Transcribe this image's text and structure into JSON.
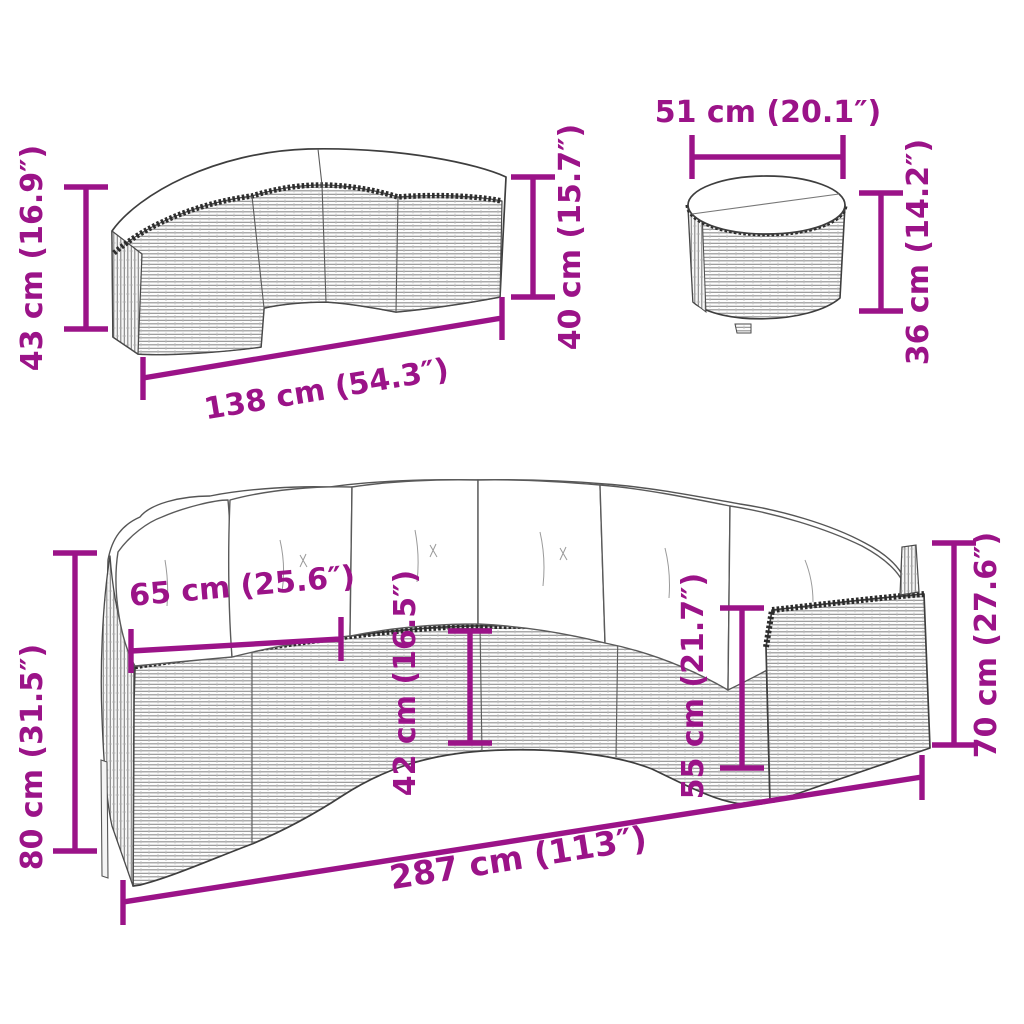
{
  "style": {
    "dimension_color": "#9B1388",
    "outline_color": "#3e3e3e",
    "weave_line_color": "#8f8f8f",
    "cushion_color": "#ffffff",
    "background": "#ffffff"
  },
  "figures": {
    "bench": {
      "dimensions": {
        "height_left": "43 cm (16.9″)",
        "width": "138 cm (54.3″)",
        "height_right": "40 cm (15.7″)"
      }
    },
    "side_table": {
      "dimensions": {
        "diameter": "51 cm (20.1″)",
        "height": "36 cm (14.2″)"
      }
    },
    "sofa": {
      "dimensions": {
        "height_left": "80 cm (31.5″)",
        "seat_depth": "65 cm (25.6″)",
        "front_wall": "42 cm (16.5″)",
        "seat_height": "55 cm (21.7″)",
        "height_right": "70 cm (27.6″)",
        "width": "287 cm (113″)"
      }
    }
  }
}
